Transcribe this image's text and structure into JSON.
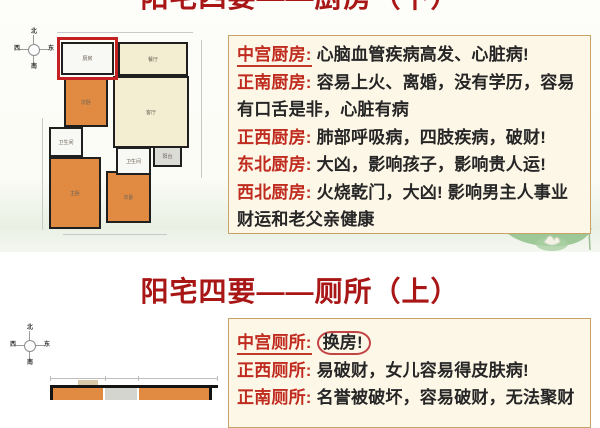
{
  "slide1": {
    "title": "阳宅四要——厨房（下）",
    "entries": [
      {
        "label": "中宫厨房",
        "text": "心脑血管疾病高发、心脏病!",
        "underline": true
      },
      {
        "label": "正南厨房",
        "text": "容易上火、离婚，没有学历，容易有口舌是非，心脏有病"
      },
      {
        "label": "正西厨房",
        "text": "肺部呼吸病，四肢疾病，破财!"
      },
      {
        "label": "东北厨房",
        "text": "大凶，影响孩子，影响贵人运!"
      },
      {
        "label": "西北厨房",
        "text": "火烧乾门，大凶! 影响男主人事业财运和老父亲健康"
      }
    ],
    "floorplan": {
      "rooms": [
        {
          "label": "厨房"
        },
        {
          "label": "餐厅"
        },
        {
          "label": "客厅"
        },
        {
          "label": "次卧"
        },
        {
          "label": "卫生间"
        },
        {
          "label": "主卧"
        },
        {
          "label": "次卧"
        },
        {
          "label": "卫生间"
        },
        {
          "label": "阳台"
        }
      ]
    }
  },
  "slide2": {
    "title": "阳宅四要——厕所（上）",
    "entries": [
      {
        "label": "中宫厕所",
        "text": "换房!",
        "underline": true,
        "circled": true
      },
      {
        "label": "正西厕所",
        "text": "易破财，女儿容易得皮肤病!"
      },
      {
        "label": "正南厕所",
        "text": "名誉被破坏，容易破财，无法聚财"
      }
    ]
  },
  "compass": {
    "n": "北",
    "s": "南",
    "e": "东",
    "w": "西"
  },
  "colors": {
    "title_red": "#a81616",
    "label_red": "#bf2b1f",
    "box_bg": "#fdf7e7",
    "box_border": "#c9a268",
    "room_orange": "#e08a42",
    "room_cream": "#f3edd2",
    "highlight_red": "#c42222"
  }
}
